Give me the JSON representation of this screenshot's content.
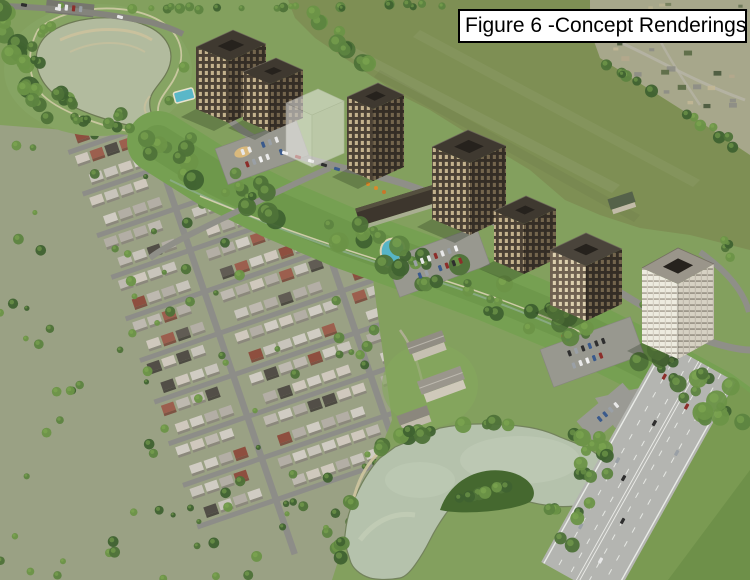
{
  "figure_label": {
    "text": "Figure 6 -Concept Renderings"
  },
  "palette": {
    "canvas_green": "#83a05e",
    "field_olive": "#7e8f54",
    "suburb_ground": "#9aa184",
    "street_gray": "#8d8d88",
    "road_gray": "#8f8f88",
    "parking_gray": "#98988f",
    "highway_gray": "#b4b5b1",
    "lane_marking": "#f2f2ef",
    "water_upper_pond": "#b2bb9e",
    "water_lower_pond": "#b5c2ac",
    "sand_tan": "#cdc29c",
    "tree_greens": [
      "#4e7238",
      "#5d8440",
      "#3f6230",
      "#6b9447"
    ],
    "tree_highlight": "#83ad53",
    "roof_light_grays": [
      "#c8c4bb",
      "#beb9b0",
      "#d0ccc3",
      "#b3aea5",
      "#cfc8bd"
    ],
    "roof_dark_grays": [
      "#615c54",
      "#524e47"
    ],
    "brick_reds": [
      "#9c5f4e",
      "#8e4f3f"
    ],
    "village_tones": [
      "#48583b",
      "#c2b795",
      "#8d8d85",
      "#5a6a44",
      "#b5a98c"
    ],
    "building_roof_dark": "#3f3930",
    "building_face_bright": "#4a4034",
    "building_face_shaded": "#342d25",
    "building_face_sunlit": "#6e6050",
    "balcony_white": "#edebdf",
    "ghost_white": "#f7f7f4",
    "window_warm": "#d9c69c",
    "pool_blue": "#57b4c6",
    "car_colors": [
      "#e8e8e8",
      "#e8e8e8",
      "#f2f2f2",
      "#2e2e2e",
      "#9aa0a6",
      "#8c2e2a",
      "#3a5a8c"
    ],
    "shadow_green": "#1e2a16",
    "label_background": "#ffffff",
    "label_border": "#000000",
    "label_text": "#000000"
  },
  "scene": {
    "type": "aerial-concept-rendering",
    "elements": [
      "figure-label",
      "open-field",
      "distant-village",
      "upper-stormwater-pond",
      "pond-trail",
      "existing-suburb",
      "greenway-corridor",
      "creek-trail",
      "apartment-tower-1",
      "apartment-midrise-2",
      "ghost-future-building",
      "apartment-tower-3",
      "apartment-tower-4",
      "apartment-midrise-5",
      "apartment-midrise-6",
      "balcony-tower-7",
      "retail-pavilion",
      "amenity-house",
      "outdoor-pool-1",
      "outdoor-pool-2",
      "playground",
      "estate-houses",
      "lower-pond",
      "highway",
      "parking-lots",
      "cars"
    ]
  }
}
